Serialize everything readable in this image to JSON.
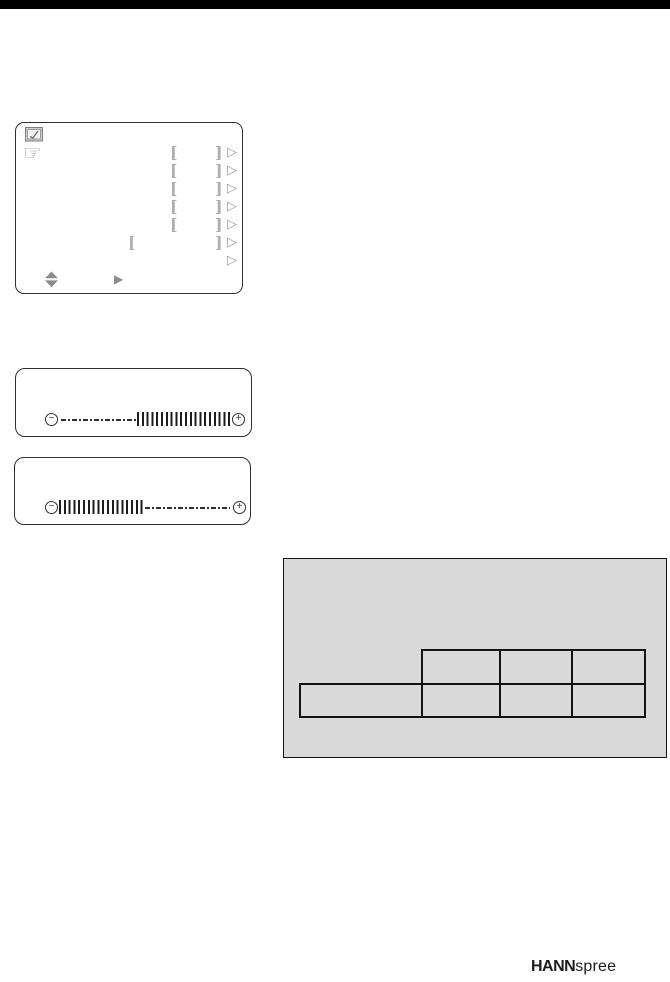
{
  "page": {
    "top_bar_color": "#000000",
    "background": "#ffffff"
  },
  "osd_menu": {
    "screen_icon_name": "osd-screen-icon",
    "hand_glyph": "☞",
    "rows": [
      {
        "open": "[",
        "close": "]",
        "arrow": "▷"
      },
      {
        "open": "[",
        "close": "]",
        "arrow": "▷"
      },
      {
        "open": "[",
        "close": "]",
        "arrow": "▷"
      },
      {
        "open": "[",
        "close": "]",
        "arrow": "▷"
      },
      {
        "open": "[",
        "close": "]",
        "arrow": "▷"
      },
      {
        "open": "[",
        "close": "]",
        "arrow": "▷",
        "wide": true
      },
      {
        "arrow": "▷"
      }
    ],
    "nav_right_glyph": "▶"
  },
  "sliders": [
    {
      "minus_glyph": "−",
      "plus_glyph": "+",
      "fill_side": "right"
    },
    {
      "minus_glyph": "−",
      "plus_glyph": "+",
      "fill_side": "left"
    }
  ],
  "table_panel": {
    "background": "#d9d9d9",
    "header_cells": [
      "",
      "",
      ""
    ],
    "body_cells": [
      "",
      "",
      "",
      ""
    ]
  },
  "logo": {
    "bold_part": "HANN",
    "light_part": "spree"
  }
}
